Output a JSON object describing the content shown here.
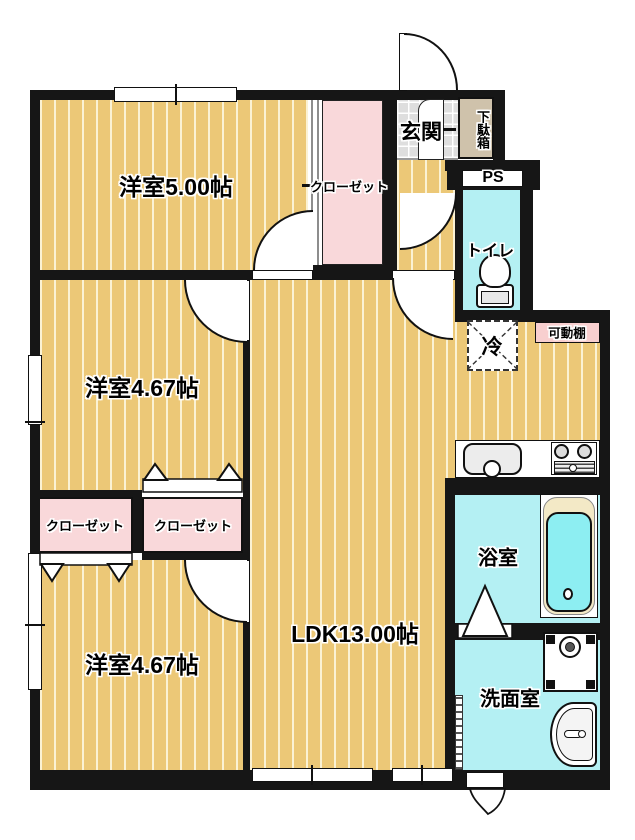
{
  "labels": {
    "bedroom5": "洋室5.00帖",
    "bedroom4a": "洋室4.67帖",
    "bedroom4b": "洋室4.67帖",
    "ldk": "LDK13.00帖",
    "entrance": "玄関",
    "shoe_box": "下駄箱",
    "ps": "PS",
    "toilet": "トイレ",
    "fridge": "冷",
    "shelf": "可動棚",
    "closet_hall": "クローゼット",
    "closet_a": "クローゼット",
    "closet_b": "クローゼット",
    "bath": "浴室",
    "washroom": "洗面室"
  },
  "colors": {
    "wall": "#161616",
    "wood_floor": "#ecc877",
    "wet_area": "#b4f0f3",
    "closet_pink": "#f9d8da",
    "shelf_pink": "#f8cfcf",
    "entrance_tile": "#dedede",
    "shoe_box_tan": "#cfc2ab",
    "bathtub_rim": "#f3e9c6",
    "bathtub_water": "#8deef2"
  }
}
